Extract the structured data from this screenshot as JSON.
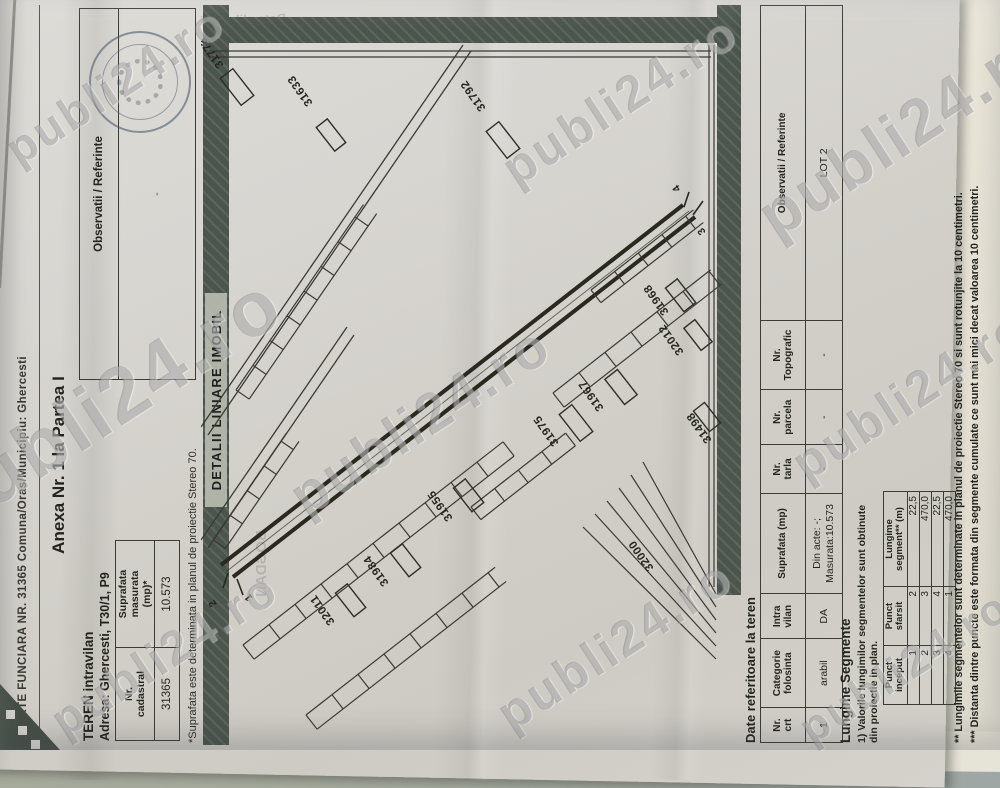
{
  "photo": {
    "watermark_text": "publi24.ro",
    "background_color": "#a3a89d",
    "paper_color": "#d6d3cd",
    "watermarks": [
      {
        "x": 115,
        "y": 85,
        "s": 46
      },
      {
        "x": 620,
        "y": 100,
        "s": 50
      },
      {
        "x": 905,
        "y": 130,
        "s": 64
      },
      {
        "x": 105,
        "y": 405,
        "s": 78
      },
      {
        "x": 420,
        "y": 420,
        "s": 56
      },
      {
        "x": 910,
        "y": 395,
        "s": 50
      },
      {
        "x": 165,
        "y": 655,
        "s": 48
      },
      {
        "x": 615,
        "y": 645,
        "s": 50
      },
      {
        "x": 905,
        "y": 668,
        "s": 44
      }
    ]
  },
  "header": {
    "carte_funciara_line": "CARTE FUNCIARA NR. 31365 Comuna/Oras/Municipiu: Ghercesti",
    "anexa_title": "Anexa Nr. 1 la Partea I",
    "teren_line": "TEREN intravilan",
    "adresa_line": "Adresa: Ghercesti, T30/1, P9"
  },
  "cadastral_table": {
    "col1_header": "Nr.\ncadastral",
    "col2_header": "Suprafata\nmasurata\n(mp)*",
    "nr_cadastral": "31365",
    "suprafata": "10.573",
    "note": "*Suprafata este determinata in planul de proiectie Stereo 70."
  },
  "observatii_box": {
    "header": "Observatii / Referinte",
    "empty_value": "-"
  },
  "plan": {
    "title": "DETALII LINIARE IMOBIL",
    "points": [
      {
        "label": "1",
        "x": 147,
        "y": 52
      },
      {
        "label": "2",
        "x": 141,
        "y": 16
      },
      {
        "label": "3",
        "x": 513,
        "y": 505
      },
      {
        "label": "4",
        "x": 556,
        "y": 480
      }
    ],
    "parcels": [
      {
        "label": "31773",
        "x": 680,
        "y": 23,
        "rot": -35
      },
      {
        "label": "31633",
        "x": 642,
        "y": 112,
        "rot": -35
      },
      {
        "label": "31792",
        "x": 637,
        "y": 285,
        "rot": -35
      },
      {
        "label": "31968",
        "x": 433,
        "y": 468,
        "rot": -35
      },
      {
        "label": "32012",
        "x": 393,
        "y": 483,
        "rot": -35
      },
      {
        "label": "31967",
        "x": 337,
        "y": 403,
        "rot": -35
      },
      {
        "label": "31975",
        "x": 302,
        "y": 358,
        "rot": -35
      },
      {
        "label": "31498",
        "x": 305,
        "y": 511,
        "rot": -35
      },
      {
        "label": "31955",
        "x": 227,
        "y": 252,
        "rot": -35
      },
      {
        "label": "31984",
        "x": 162,
        "y": 188,
        "rot": -35
      },
      {
        "label": "32011",
        "x": 123,
        "y": 134,
        "rot": -35
      },
      {
        "label": "32000",
        "x": 177,
        "y": 453,
        "rot": -35
      }
    ]
  },
  "teren_table": {
    "title": "Date referitoare la teren",
    "headers": [
      "Nr.\ncrt",
      "Categorie\nfolosinta",
      "Intra\nvilan",
      "Suprafata (mp)",
      "Nr.\ntarla",
      "Nr.\nparcela",
      "Nr.\nTopografic",
      "Observatii / Referinte"
    ],
    "col_widths": [
      30,
      64,
      40,
      96,
      44,
      50,
      64,
      344
    ],
    "rows": [
      [
        "1",
        "arabil",
        "DA",
        "Din acte: -;\nMasurata:10.573",
        "-",
        "-",
        "-",
        "LOT 2"
      ]
    ]
  },
  "segments": {
    "title": "Lungime Segmente",
    "note": "1) Valorile lungimilor segmentelor sunt obtinute din proiectie in plan.",
    "headers": [
      "Punct\ninceput",
      "Punct\nsfarsit",
      "Lungime\nsegment** (m)"
    ],
    "col_widths": [
      52,
      52,
      88
    ],
    "rows": [
      [
        "1",
        "2",
        "22,5"
      ],
      [
        "2",
        "3",
        "470,0"
      ],
      [
        "3",
        "4",
        "22,5"
      ],
      [
        "4",
        "1",
        "470,0"
      ]
    ],
    "footnote1": "** Lungimile segmentelor sunt determinate in planul de proiectie Stereo 70 si sunt rotunjite la 10 centimetri.",
    "footnote2": "*** Distanta dintre puncte este formata din segmente cumulate ce sunt mai mici decat valoarea 10 centimetri."
  },
  "ghost_bleed_text": {
    "date_line": "Data eliberarii",
    "name_line": "BOGDAN"
  }
}
